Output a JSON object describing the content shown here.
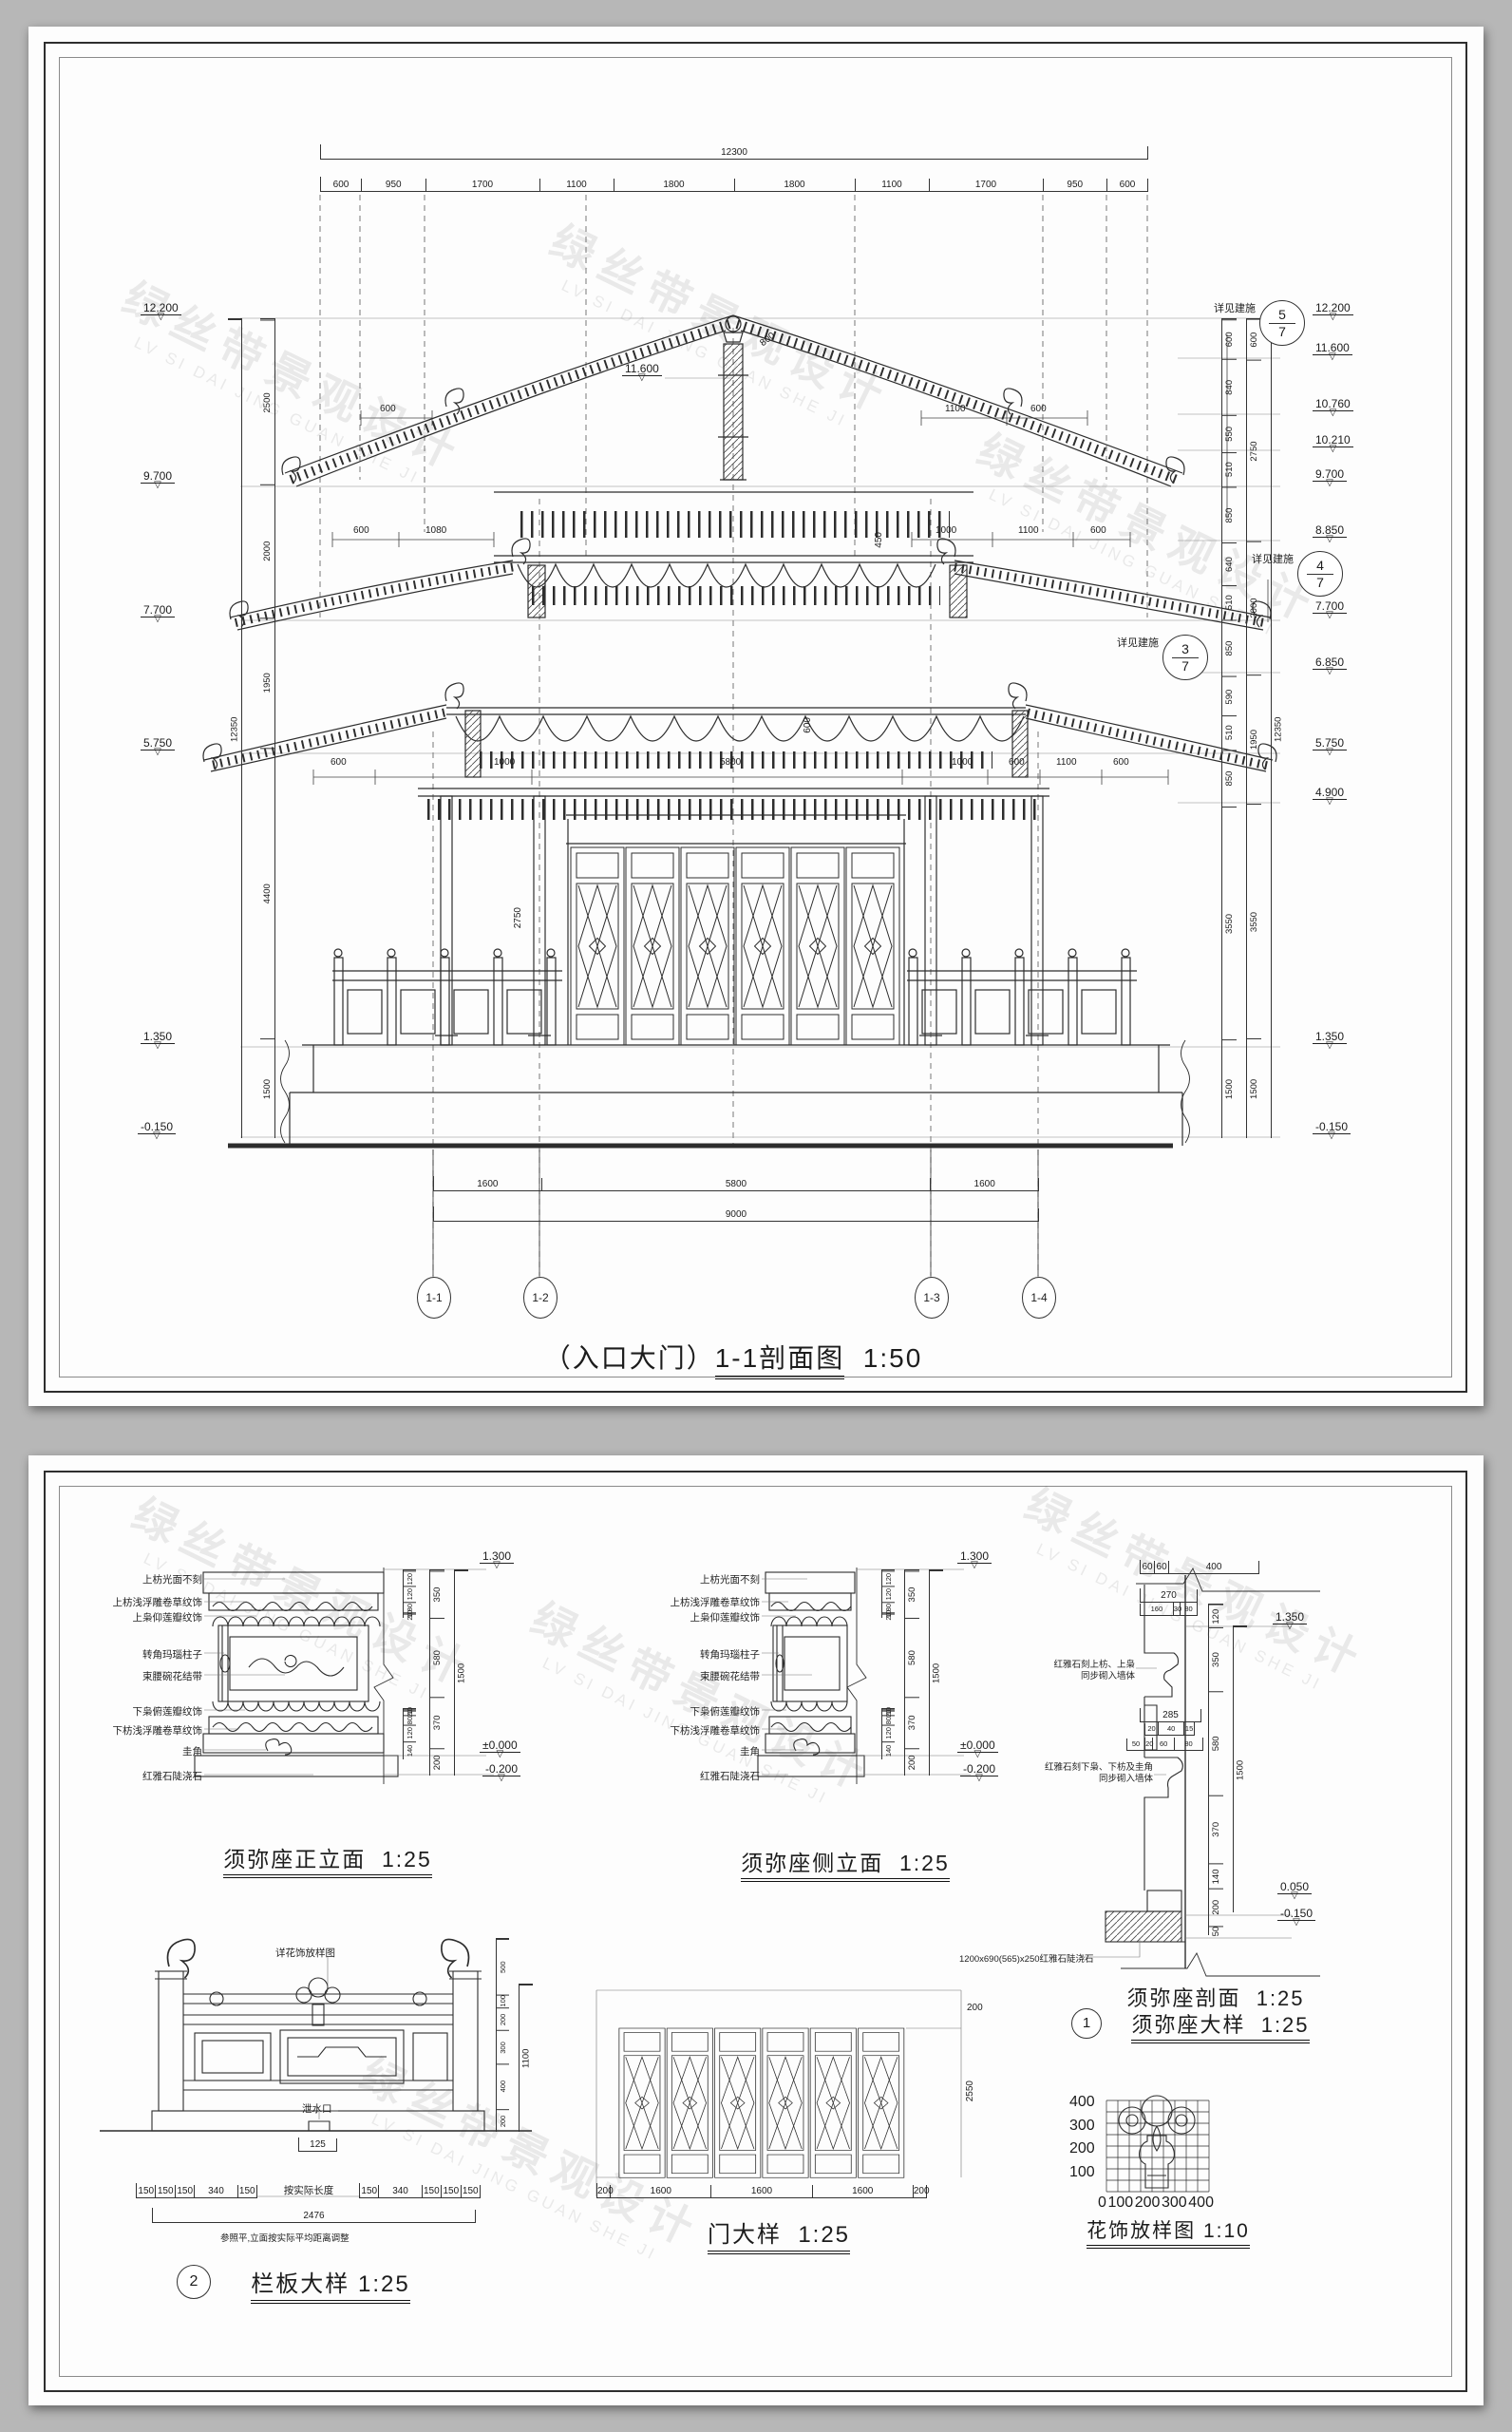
{
  "watermark": {
    "cn": "绿丝带景观设计",
    "en": "LV SI DAI JING GUAN SHE JI"
  },
  "s1": {
    "title_prefix": "（入口大门）",
    "title_main": "1-1剖面图",
    "title_scale": "1:50",
    "top_total": [
      "12300"
    ],
    "top_chain": [
      "600",
      "950",
      "1700",
      "1100",
      "1800",
      "1800",
      "1100",
      "1700",
      "950",
      "600"
    ],
    "left_levels": [
      "12.200",
      "9.700",
      "7.700",
      "5.750",
      "1.350",
      "-0.150"
    ],
    "left_chain": [
      "2500",
      "2000",
      "1950",
      "4400",
      "1500"
    ],
    "left_total": [
      "12350"
    ],
    "right_levels": [
      "12.200",
      "11.600",
      "10.760",
      "10.210",
      "9.700",
      "8.850",
      "7.700",
      "6.850",
      "5.750",
      "4.900",
      "1.350",
      "-0.150"
    ],
    "right_chain1": [
      "600",
      "840",
      "550",
      "510",
      "850",
      "640",
      "510",
      "850",
      "590",
      "510",
      "850",
      "3550",
      "1500"
    ],
    "right_chain2": [
      "600",
      "2750",
      "2000",
      "1950",
      "3550",
      "1500"
    ],
    "right_total": [
      "12350"
    ],
    "bottom_chain": [
      "1600",
      "5800",
      "1600"
    ],
    "bottom_total": [
      "9000"
    ],
    "grids": [
      "1-1",
      "1-2",
      "1-3",
      "1-4"
    ],
    "ref_label": "详见建施",
    "refs": [
      {
        "n": "5",
        "d": "7"
      },
      {
        "n": "4",
        "d": "7"
      },
      {
        "n": "3",
        "d": "7"
      }
    ],
    "ridge_level": "11.600",
    "slope_dim": "800",
    "roof_dims": [
      "600",
      "1100",
      "600"
    ],
    "mid_dims": [
      "600",
      "1080",
      "1000",
      "1100",
      "600"
    ],
    "mid_v": "450",
    "low_dims": [
      "600",
      "1000",
      "5800",
      "1000",
      "600",
      "1100",
      "600"
    ],
    "low_v": "600",
    "door_v": "2750"
  },
  "s2": {
    "front": {
      "title": "须弥座正立面",
      "scale": "1:25",
      "labels": [
        "上枋光面不刻",
        "上枋浅浮雕卷草纹饰",
        "上枭仰莲瓣纹饰",
        "转角玛瑙柱子",
        "束腰碗花结带",
        "下枭俯莲瓣纹饰",
        "下枋浅浮雕卷草纹饰",
        "圭角",
        "红雅石陡浇石"
      ],
      "sub_top": [
        "120",
        "120",
        "80",
        "10",
        "20"
      ],
      "chain": [
        "350",
        "580",
        "370",
        "200"
      ],
      "sub_bottom": [
        "10",
        "20",
        "80",
        "120",
        "140"
      ],
      "total": [
        "1500"
      ],
      "levels": [
        "1.300",
        "±0.000",
        "-0.200"
      ]
    },
    "side": {
      "title": "须弥座侧立面",
      "scale": "1:25",
      "labels": [
        "上枋光面不刻",
        "上枋浅浮雕卷草纹饰",
        "上枭仰莲瓣纹饰",
        "转角玛瑙柱子",
        "束腰碗花结带",
        "下枭俯莲瓣纹饰",
        "下枋浅浮雕卷草纹饰",
        "圭角",
        "红雅石陡浇石"
      ],
      "sub_top": [
        "120",
        "120",
        "80",
        "10",
        "20"
      ],
      "chain": [
        "350",
        "580",
        "370",
        "200"
      ],
      "sub_bottom": [
        "10",
        "20",
        "80",
        "120",
        "140"
      ],
      "total": [
        "1500"
      ],
      "levels": [
        "1.300",
        "±0.000",
        "-0.200"
      ]
    },
    "section": {
      "title1": "须弥座剖面",
      "scale1": "1:25",
      "bubble": "1",
      "title2": "须弥座大样",
      "scale2": "1:25",
      "top_chain": [
        "60",
        "60",
        "400"
      ],
      "d270": [
        "270"
      ],
      "sub270": [
        "160",
        "30",
        "80"
      ],
      "d285": [
        "285"
      ],
      "sub285": [
        "20",
        "40",
        "15"
      ],
      "subb": [
        "50",
        "20",
        "60",
        "80"
      ],
      "note1a": "红雅石刻上枋、上枭",
      "note1b": "同步砌入墙体",
      "note2a": "红雅石刻下枭、下枋及圭角",
      "note2b": "同步砌入墙体",
      "note3": "1200x690(565)x250红雅石陡浇石",
      "chain": [
        "120",
        "350",
        "580",
        "370",
        "140",
        "200",
        "50"
      ],
      "total": [
        "1500"
      ],
      "levels": [
        "1.350",
        "0.050",
        "-0.150"
      ]
    },
    "balustrade": {
      "bubble": "2",
      "title": "栏板大样",
      "scale": "1:25",
      "ref": "详花饰放样图",
      "drain": "泄水口",
      "d125": [
        "125"
      ],
      "chain_l": [
        "150",
        "150",
        "150",
        "340",
        "150"
      ],
      "mid": "按实际长度",
      "chain_r": [
        "150",
        "340",
        "150",
        "150",
        "150"
      ],
      "total": [
        "2476"
      ],
      "note": "参照平,立面按实际平均距离调整",
      "vchain": [
        "500",
        "100",
        "200",
        "300",
        "400",
        "200"
      ],
      "vtotal": [
        "1100"
      ]
    },
    "door": {
      "title": "门大样",
      "scale": "1:25",
      "bottom": [
        "200",
        "1600",
        "1600",
        "1600",
        "200"
      ],
      "top_r": "200",
      "height": "2550"
    },
    "flower": {
      "title": "花饰放样图",
      "scale": "1:10",
      "x": [
        "0",
        "100",
        "200",
        "300",
        "400"
      ],
      "y": [
        "400",
        "300",
        "200",
        "100"
      ]
    }
  }
}
